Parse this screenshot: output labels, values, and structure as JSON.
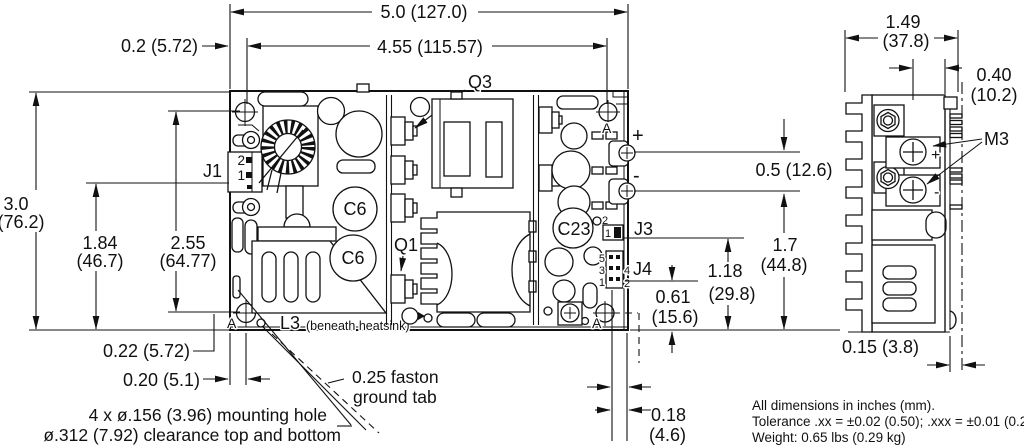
{
  "colors": {
    "ink": "#111111",
    "paper": "#ffffff"
  },
  "notes": {
    "line1": "All dimensions in inches (mm).",
    "line2": "Tolerance .xx = ±0.02 (0.50); .xxx = ±0.01 (0.25)",
    "line3": "Weight: 0.65 lbs (0.29 kg)"
  },
  "callouts": {
    "mounting_hole_line1": "4 x ø.156 (3.96) mounting hole",
    "mounting_hole_line2": "ø.312 (7.92) clearance top and bottom",
    "ground_tab_line1": "0.25 faston",
    "ground_tab_line2": "ground tab",
    "beneath_heatsink": "(beneath heatsink)"
  },
  "components": {
    "j1": "J1",
    "q3": "Q3",
    "q1": "Q1",
    "c6": "C6",
    "c23": "C23",
    "l3": "L3",
    "j3": "J3",
    "j4": "J4",
    "m3": "M3",
    "hole": "A",
    "plus": "+",
    "minus": "-"
  },
  "pins": {
    "j1": [
      "2",
      "1"
    ],
    "j3": [
      "2",
      "1"
    ],
    "j4_left": [
      "5",
      "3",
      "1"
    ],
    "j4_right": [
      "4",
      "2"
    ]
  },
  "dimensions": {
    "board_width": "5.0 (127.0)",
    "hole_span_h": "4.55 (115.57)",
    "edge_to_hole": "0.2 (5.72)",
    "board_height_in": "3.0",
    "board_height_mm": "(76.2)",
    "j1_pin_in": "1.84",
    "j1_pin_mm": "(46.7)",
    "hole_span_v_in": "2.55",
    "hole_span_v_mm": "(64.77)",
    "hole_bottom": "0.22 (5.72)",
    "hole_left": "0.20 (5.1)",
    "terminal_pitch": "0.5 (12.6)",
    "minus_height_in": "1.7",
    "minus_height_mm": "(44.8)",
    "j3_height_in": "1.18",
    "j3_height_mm": "(29.8)",
    "j4_height_in": "0.61",
    "j4_height_mm": "(15.6)",
    "j4_edge_in": "0.18",
    "j4_edge_mm": "(4.6)",
    "side_width_in": "1.49",
    "side_width_mm": "(37.8)",
    "side_depth_in": "0.40",
    "side_depth_mm": "(10.2)",
    "pcb_thickness": "0.15 (3.8)"
  }
}
